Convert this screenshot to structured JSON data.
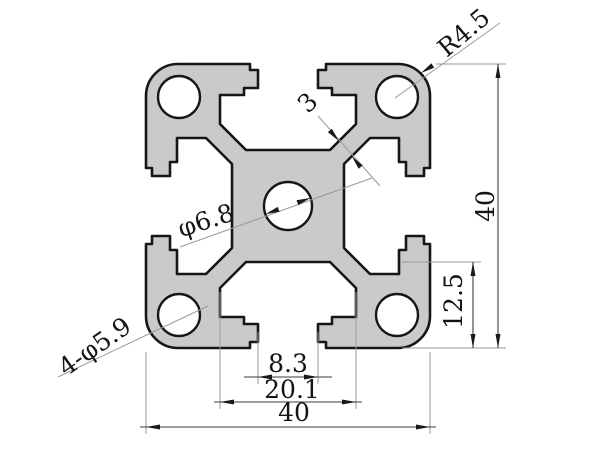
{
  "drawing": {
    "labels": {
      "corner_radius": "R4.5",
      "overall_height": "40",
      "slot_floor_offset": "12.5",
      "slot_opening_width": "8.3",
      "slot_inner_width": "20.1",
      "overall_width": "40",
      "center_hole_dia": "φ6.8",
      "corner_holes_dia": "4-φ5.9",
      "web_thickness": "3"
    },
    "colors": {
      "background": "#ffffff",
      "profile_fill": "#c9cacb",
      "profile_outline": "#161616",
      "dimension_line": "#3c3c3c",
      "extension_line": "#9a9a9a",
      "text": "#141414"
    }
  }
}
